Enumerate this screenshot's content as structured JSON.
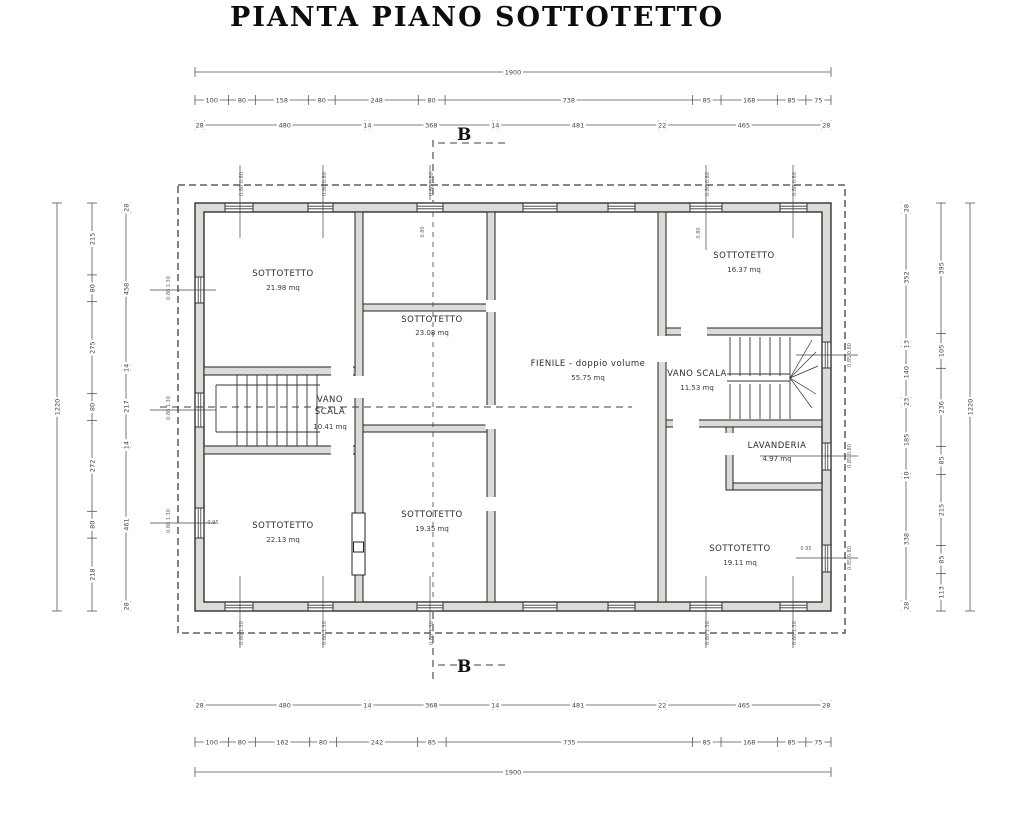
{
  "title": "PIANTA PIANO SOTTOTETTO",
  "section_label": "B",
  "rooms": [
    {
      "id": "sottotetto-top-left",
      "name": "SOTTOTETTO",
      "area": "21.98 mq"
    },
    {
      "id": "sottotetto-mid-top",
      "name": "SOTTOTETTO",
      "area": "23.08 mq"
    },
    {
      "id": "fienile",
      "name": "FIENILE - doppio volume",
      "area": "55.75 mq"
    },
    {
      "id": "sottotetto-top-right",
      "name": "SOTTOTETTO",
      "area": "16.37 mq"
    },
    {
      "id": "vano-scala-left",
      "name": "VANO SCALA",
      "area": "10.41 mq"
    },
    {
      "id": "vano-scala-right",
      "name": "VANO SCALA",
      "area": "11.53 mq"
    },
    {
      "id": "lavanderia",
      "name": "LAVANDERIA",
      "area": "4.97 mq"
    },
    {
      "id": "sottotetto-bottom-left",
      "name": "SOTTOTETTO",
      "area": "22.13 mq"
    },
    {
      "id": "sottotetto-bottom-mid",
      "name": "SOTTOTETTO",
      "area": "19.35 mq"
    },
    {
      "id": "sottotetto-bottom-right",
      "name": "SOTTOTETTO",
      "area": "19.11 mq"
    }
  ],
  "dimensions": {
    "top_total": [
      1900
    ],
    "top_detail": [
      100,
      80,
      158,
      80,
      248,
      80,
      738,
      85,
      168,
      85,
      75
    ],
    "top_grid": [
      28,
      480,
      14,
      368,
      14,
      481,
      22,
      465,
      28
    ],
    "bottom_grid": [
      28,
      480,
      14,
      368,
      14,
      481,
      22,
      465,
      28
    ],
    "bottom_detail": [
      100,
      80,
      162,
      80,
      242,
      85,
      735,
      85,
      168,
      85,
      75
    ],
    "bottom_total": [
      1900
    ],
    "left_total": [
      1220
    ],
    "left_detail": [
      215,
      80,
      275,
      80,
      272,
      80,
      218
    ],
    "left_grid": [
      28,
      458,
      14,
      217,
      14,
      461,
      28
    ],
    "right_grid": [
      28,
      352,
      13,
      140,
      23,
      185,
      10,
      338,
      28
    ],
    "right_detail": [
      395,
      105,
      236,
      85,
      215,
      85,
      113
    ],
    "right_total": [
      1220
    ]
  },
  "window_tags": {
    "top": "0.80 0.80",
    "bottom": "0.80 1.30",
    "left": "0.80 1.30",
    "right": "0.85 0.80",
    "inline_095": "0.95",
    "inline_080": "0.80"
  },
  "colors": {
    "wall_fill": "#dbdbd8",
    "line": "#222222",
    "dash": "#3f3f3f",
    "roof_dash": "#c8c8c8",
    "text": "#333333"
  }
}
